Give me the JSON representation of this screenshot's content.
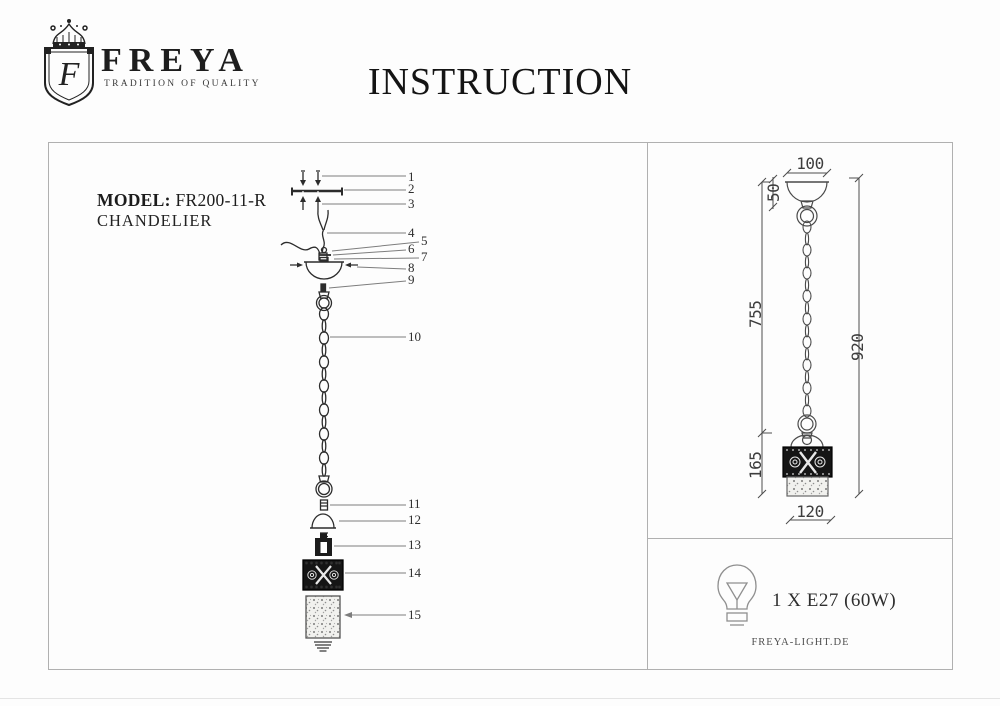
{
  "header": {
    "brand": "FREYA",
    "tagline": "TRADITION OF QUALITY",
    "title": "INSTRUCTION",
    "monogram": "F"
  },
  "model": {
    "label": "MODEL:",
    "number": "FR200-11-R",
    "type": "CHANDELIER"
  },
  "exploded_view": {
    "part_labels": [
      "1",
      "2",
      "3",
      "4",
      "5",
      "6",
      "7",
      "8",
      "9",
      "10",
      "11",
      "12",
      "13",
      "14",
      "15"
    ]
  },
  "dimensions": {
    "canopy_width_mm": "100",
    "canopy_drop_mm": "50",
    "chain_drop_mm": "755",
    "overall_drop_mm": "920",
    "shade_drop_mm": "165",
    "shade_width_mm": "120"
  },
  "lamp": {
    "bulb_spec": "1 X E27 (60W)",
    "website": "FREYA-LIGHT.DE"
  },
  "icons": {
    "logo": "freya-crest-icon",
    "bulb": "light-bulb-icon"
  },
  "colors": {
    "ink": "#1a1a1a",
    "drawing_line": "#2c2c2c",
    "dimension_line": "#4d4d4d",
    "leader_line": "#7d7d7d",
    "panel_border": "#b0b0b0"
  }
}
